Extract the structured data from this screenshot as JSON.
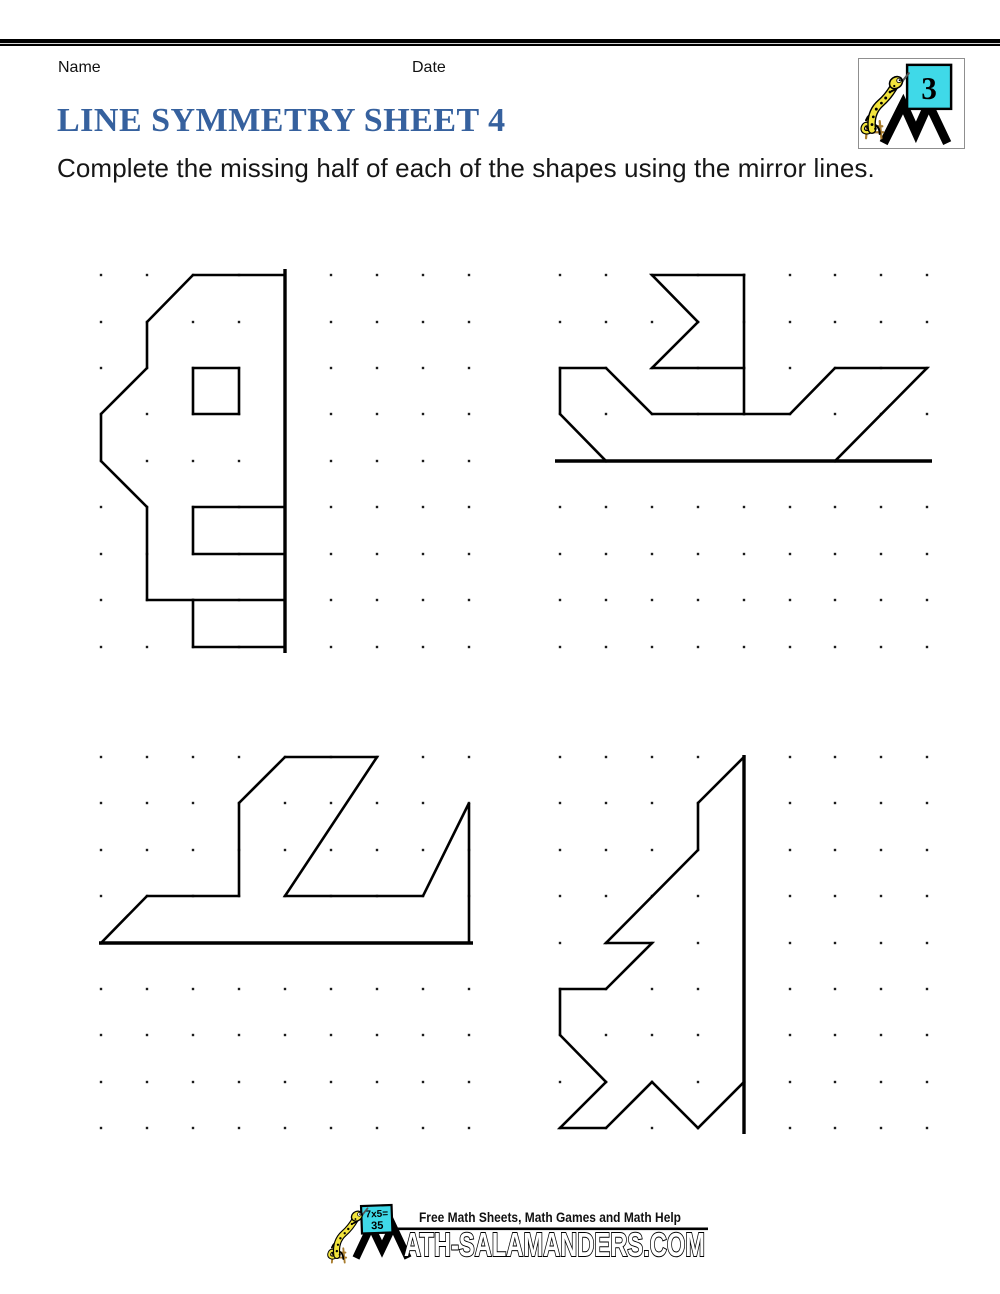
{
  "page": {
    "width": 1000,
    "height": 1294,
    "background": "#ffffff"
  },
  "header": {
    "name_label": "Name",
    "date_label": "Date",
    "grade_badge": "3"
  },
  "title": "LINE SYMMETRY SHEET 4",
  "instruction": "Complete the missing half of each of the shapes using the mirror lines.",
  "colors": {
    "title_blue": "#36619E",
    "ink": "#000000",
    "dot": "#1c1c1c",
    "cyan_sign": "#3FD9E8",
    "salamander_yellow": "#F2E43C",
    "stool_brown": "#A97D2F"
  },
  "worksheet": {
    "dot_size": 2.4,
    "shape_stroke": 2.6,
    "mirror_stroke": 3.4,
    "grids": [
      {
        "name": "top-left",
        "cols": [
          101,
          147,
          193,
          239,
          285,
          331,
          377,
          423,
          469
        ],
        "rows": [
          275,
          322,
          368,
          414,
          461,
          507,
          554,
          600,
          647
        ]
      },
      {
        "name": "top-right",
        "cols": [
          560,
          606,
          652,
          698,
          744,
          790,
          835,
          881,
          927
        ],
        "rows": [
          275,
          322,
          368,
          414,
          461,
          507,
          554,
          600,
          647
        ]
      },
      {
        "name": "bottom-left",
        "cols": [
          101,
          147,
          193,
          239,
          285,
          331,
          377,
          423,
          469
        ],
        "rows": [
          757,
          803,
          850,
          896,
          943,
          989,
          1035,
          1082,
          1128
        ]
      },
      {
        "name": "bottom-right",
        "cols": [
          560,
          606,
          652,
          698,
          744,
          790,
          835,
          881,
          927
        ],
        "rows": [
          757,
          803,
          850,
          896,
          943,
          989,
          1035,
          1082,
          1128
        ]
      }
    ],
    "figures": [
      {
        "name": "half-truck",
        "grid": 0,
        "polylines": [
          {
            "points": [
              [
                4,
                0
              ],
              [
                2,
                0
              ],
              [
                1,
                1
              ],
              [
                1,
                2
              ],
              [
                0,
                3
              ],
              [
                0,
                4
              ],
              [
                1,
                5
              ],
              [
                1,
                7
              ],
              [
                4,
                7
              ]
            ],
            "closed": false
          },
          {
            "points": [
              [
                2,
                7
              ],
              [
                2,
                8
              ],
              [
                4,
                8
              ]
            ],
            "closed": false
          },
          {
            "points": [
              [
                2,
                2
              ],
              [
                3,
                2
              ],
              [
                3,
                3
              ],
              [
                2,
                3
              ]
            ],
            "closed": true
          },
          {
            "points": [
              [
                4,
                5
              ],
              [
                2,
                5
              ],
              [
                2,
                6
              ],
              [
                4,
                6
              ]
            ],
            "closed": false
          }
        ],
        "mirror": {
          "orientation": "vertical",
          "line": 4,
          "from": 0,
          "to": 8,
          "pad_start": 6,
          "pad_end": 6
        }
      },
      {
        "name": "half-boat",
        "grid": 1,
        "polylines": [
          {
            "points": [
              [
                4,
                0
              ],
              [
                2,
                0
              ],
              [
                3,
                1
              ],
              [
                2,
                2
              ],
              [
                4,
                2
              ]
            ],
            "closed": false
          },
          {
            "points": [
              [
                4,
                0
              ],
              [
                4,
                3
              ]
            ],
            "closed": false
          },
          {
            "points": [
              [
                6,
                4
              ],
              [
                8,
                2
              ],
              [
                6,
                2
              ],
              [
                5,
                3
              ],
              [
                2,
                3
              ],
              [
                1,
                2
              ],
              [
                0,
                2
              ],
              [
                0,
                3
              ],
              [
                1,
                4
              ]
            ],
            "closed": false
          }
        ],
        "mirror": {
          "orientation": "horizontal",
          "line": 4,
          "from": 0,
          "to": 8,
          "pad_start": 5,
          "pad_end": 5
        }
      },
      {
        "name": "half-ship",
        "grid": 2,
        "polylines": [
          {
            "points": [
              [
                0,
                4
              ],
              [
                1,
                3
              ],
              [
                3,
                3
              ],
              [
                3,
                1
              ],
              [
                4,
                0
              ],
              [
                6,
                0
              ],
              [
                4,
                3
              ],
              [
                7,
                3
              ],
              [
                8,
                1
              ],
              [
                8,
                4
              ]
            ],
            "closed": false
          }
        ],
        "mirror": {
          "orientation": "horizontal",
          "line": 4,
          "from": 0,
          "to": 8,
          "pad_start": 2,
          "pad_end": 4
        }
      },
      {
        "name": "half-jet",
        "grid": 3,
        "polylines": [
          {
            "points": [
              [
                4,
                0
              ],
              [
                3,
                1
              ],
              [
                3,
                2
              ],
              [
                1,
                4
              ],
              [
                2,
                4
              ],
              [
                1,
                5
              ],
              [
                0,
                5
              ],
              [
                0,
                6
              ],
              [
                1,
                7
              ],
              [
                0,
                8
              ],
              [
                1,
                8
              ],
              [
                2,
                7
              ],
              [
                3,
                8
              ],
              [
                4,
                7
              ]
            ],
            "closed": false
          }
        ],
        "mirror": {
          "orientation": "vertical",
          "line": 4,
          "from": 0,
          "to": 8,
          "pad_start": 2,
          "pad_end": 6
        }
      }
    ]
  },
  "footer": {
    "sign_line1": "7x5=",
    "sign_line2": "35",
    "tagline": "Free Math Sheets, Math Games and Math Help",
    "wordmark": "ATH-SALAMANDERS.COM"
  }
}
